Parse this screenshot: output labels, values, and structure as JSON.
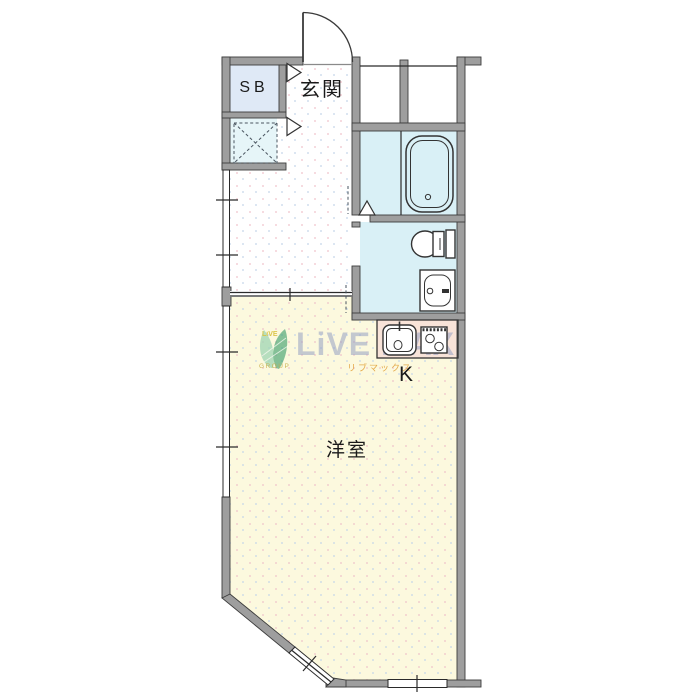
{
  "plan": {
    "labels": {
      "shoe_box": "SB",
      "entrance": "玄関",
      "kitchen": "K",
      "western_room": "洋室"
    },
    "watermark": {
      "brand": "LiVE MAX",
      "brand_small": "LiVE",
      "group": "GROUP",
      "katakana": "リブマックス"
    },
    "colors": {
      "wall": "#9e9e9e",
      "wet_area": "#d9f0f6",
      "closet": "#dfe9f6",
      "laundry": "#e6f5f8",
      "room": "#fcf9de",
      "corridor": "#ffffff",
      "counter": "#f8e3d8",
      "watermark_text": "#96a1c3",
      "watermark_accent": "#e2a23c",
      "watermark_gold": "#c9ae4a",
      "watermark_leaf": "#3fa070"
    },
    "fixtures": {
      "bathtub": "bathtub",
      "toilet": "toilet",
      "washbasin": "washbasin",
      "kitchen_sink": "kitchen-sink",
      "gas_stove": "two-burner-stove",
      "washer_pan": "washing-machine-pan",
      "entrance_door": "entrance-door-swing"
    }
  }
}
